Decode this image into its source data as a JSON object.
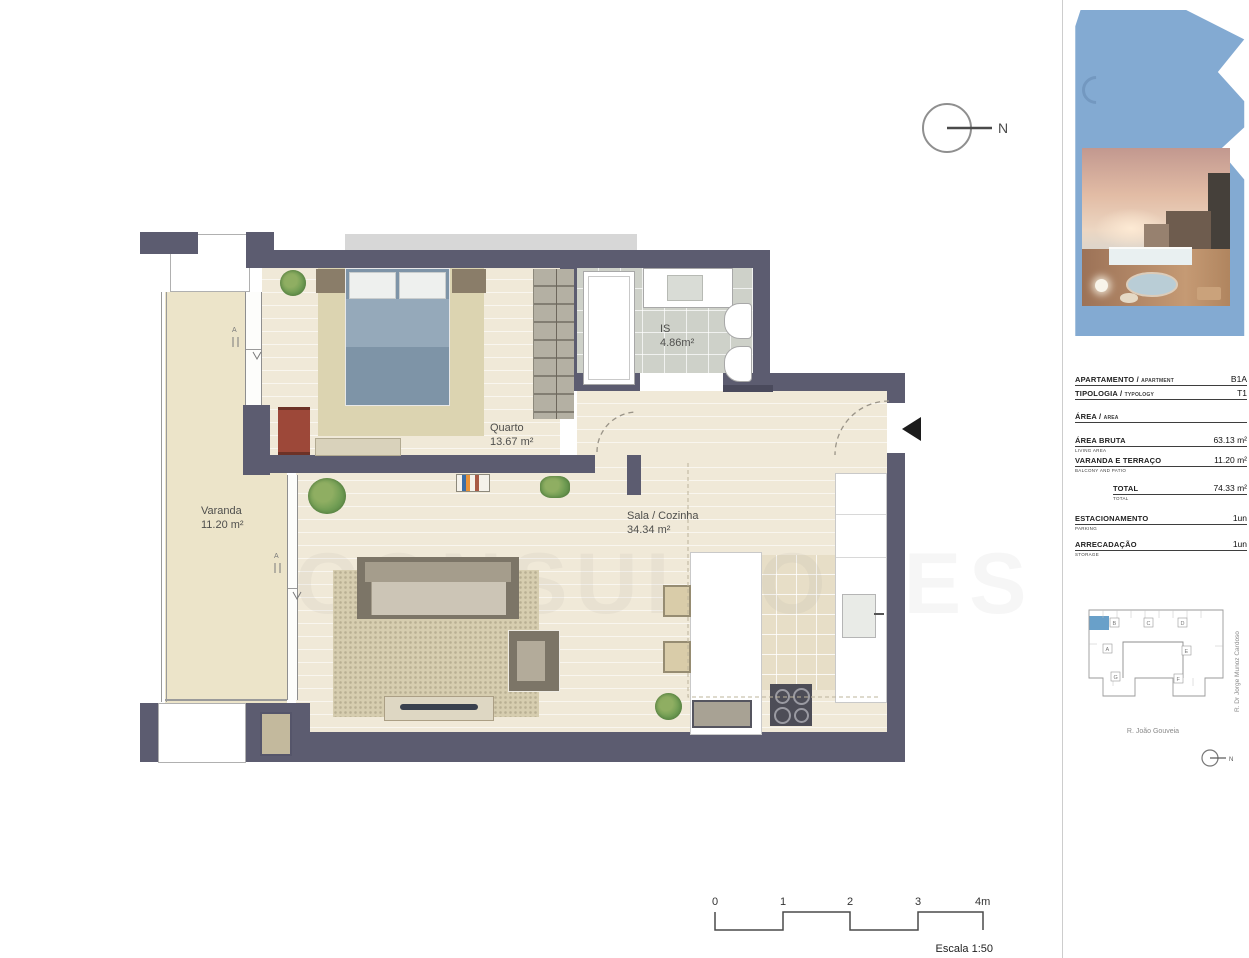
{
  "plan": {
    "rooms": [
      {
        "id": "quarto",
        "label": "Quarto",
        "area": "13.67 m²"
      },
      {
        "id": "sala",
        "label": "Sala / Cozinha",
        "area": "34.34 m²"
      },
      {
        "id": "is",
        "label": "IS",
        "area": "4.86m²"
      },
      {
        "id": "varanda",
        "label": "Varanda",
        "area": "11.20 m²"
      }
    ],
    "north_label": "N",
    "watermark": "CONSULTORES",
    "door_marks": {
      "a": "A",
      "v": "V"
    }
  },
  "scalebar": {
    "ticks": [
      "0",
      "1",
      "2",
      "3",
      "4m"
    ],
    "caption": "Escala 1:50"
  },
  "sidebar": {
    "table": {
      "rows": [
        {
          "label": "APARTAMENTO /",
          "label_en": "APARTMENT",
          "sub": "",
          "value": "B1A"
        },
        {
          "label": "TIPOLOGIA /",
          "label_en": "TYPOLOGY",
          "sub": "",
          "value": "T1"
        },
        {
          "label": "ÁREA /",
          "label_en": "AREA",
          "sub": "",
          "value": ""
        },
        {
          "label": "ÁREA BRUTA",
          "label_en": "",
          "sub": "LIVING AREA",
          "value": "63.13 m²"
        },
        {
          "label": "VARANDA E TERRAÇO",
          "label_en": "",
          "sub": "BALCONY AND PATIO",
          "value": "11.20 m²"
        },
        {
          "label": "TOTAL",
          "label_en": "",
          "sub": "TOTAL",
          "value": "74.33 m²"
        },
        {
          "label": "ESTACIONAMENTO",
          "label_en": "",
          "sub": "PARKING",
          "value": "1un"
        },
        {
          "label": "ARRECADAÇÃO",
          "label_en": "",
          "sub": "STORAGE",
          "value": "1un"
        }
      ]
    },
    "siteplan": {
      "units": [
        "B",
        "C",
        "D",
        "A",
        "E",
        "G",
        "F"
      ],
      "street_bottom": "R. João Gouveia",
      "street_right": "R. Dr Jorge Munoz Cardoso",
      "north_label": "N",
      "highlight_color": "#69a0c9"
    }
  },
  "colors": {
    "wall": "#5c5c70",
    "logo_blue": "#83aad2",
    "balcony_floor": "#ece4c9",
    "plank_floor": "#f0e9d8",
    "bath_tile": "#ced1c9"
  }
}
